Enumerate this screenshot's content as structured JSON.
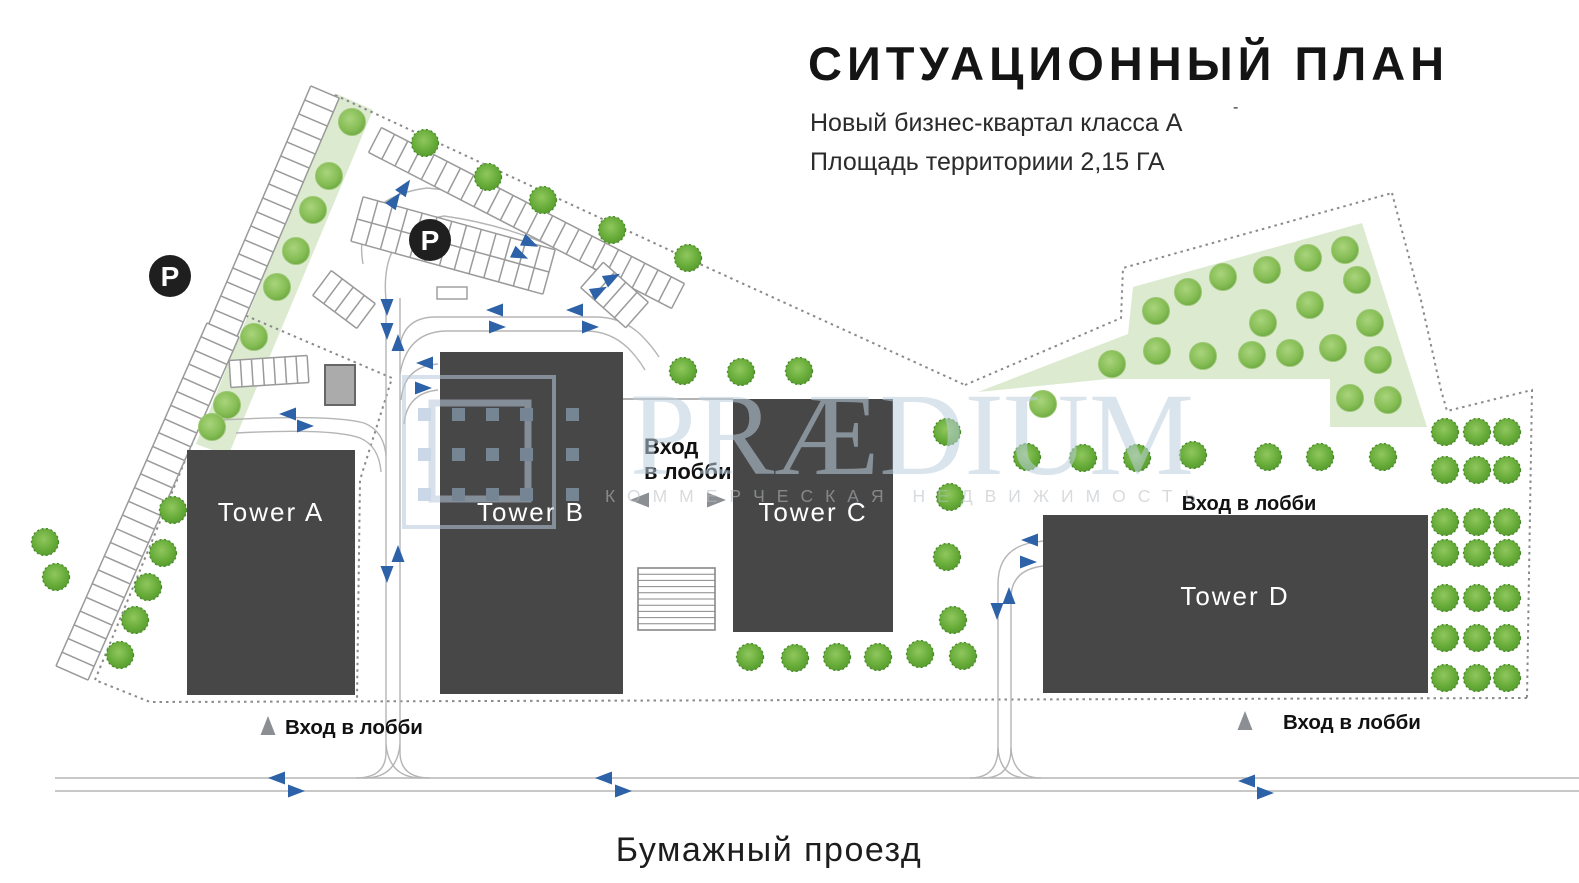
{
  "header": {
    "title": "СИТУАЦИОННЫЙ ПЛАН",
    "subtitle_line1": "Новый бизнес-квартал класса А",
    "subtitle_sup": "-",
    "subtitle_line2": "Площадь территориии 2,15 ГА"
  },
  "towers": {
    "a": "Tower A",
    "b": "Tower B",
    "c": "Tower C",
    "d": "Tower D"
  },
  "labels": {
    "entrance_mid_line1": "Вход",
    "entrance_mid_line2": "в лобби",
    "entrance_top_d": "Вход в лобби",
    "entrance_bottom_left": "Вход в лобби",
    "entrance_bottom_right": "Вход в лобби",
    "street": "Бумажный проезд",
    "parking_badge": "P"
  },
  "watermark": {
    "brand": "PRÆDIUM",
    "tagline": "КОММЕРЧЕСКАЯ НЕДВИЖИМОСТЬ"
  },
  "icons": {
    "parking_icon": "P-badge-circle",
    "tree_icon": "tree-crown-circle",
    "direction_arrow_icon": "blue-triangle",
    "entrance_arrow_icon": "gray-triangle"
  },
  "colors": {
    "tower_fill": "#474747",
    "accent_blue": "#2d62a8",
    "green_area": "#dcead0",
    "tree_green": "#6fae41",
    "road_gray": "#b5b5b5",
    "boundary_gray": "#8a8a8a",
    "entrance_gray": "#8b8f93",
    "badge_black": "#1f1f1f",
    "watermark_blue": "#b7c8dc"
  }
}
